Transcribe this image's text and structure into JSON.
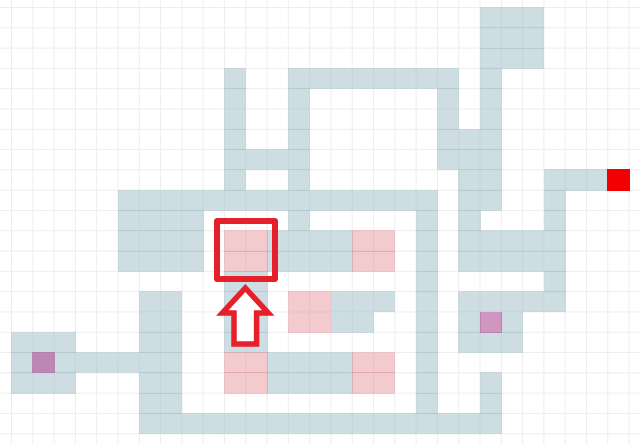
{
  "map": {
    "title_hidden": "",
    "grid": {
      "origin_x": 11,
      "origin_y": 7,
      "cell_w": 21.3,
      "cell_h": 20.3,
      "cols": 30,
      "rows": 22,
      "width": 640,
      "height": 444,
      "line_color": "#ededee",
      "background": "#ffffff"
    },
    "colors": {
      "wall_fill": "rgba(164,193,203,0.55)",
      "pink_fill": "rgba(226,130,140,0.42)",
      "purple_fill": "rgba(178,72,146,0.58)",
      "goal_fill": "#f20000",
      "highlight_red": "#e5202a",
      "arrow_fill": "#ffffff"
    },
    "wall_runs": [
      [
        1,
        23,
        25
      ],
      [
        2,
        23,
        25
      ],
      [
        3,
        23,
        25
      ],
      [
        4,
        11,
        11
      ],
      [
        4,
        14,
        21
      ],
      [
        4,
        23,
        23
      ],
      [
        5,
        11,
        11
      ],
      [
        5,
        14,
        14
      ],
      [
        5,
        21,
        21
      ],
      [
        5,
        23,
        23
      ],
      [
        6,
        11,
        11
      ],
      [
        6,
        14,
        14
      ],
      [
        6,
        21,
        21
      ],
      [
        6,
        23,
        23
      ],
      [
        7,
        11,
        11
      ],
      [
        7,
        14,
        14
      ],
      [
        7,
        21,
        23
      ],
      [
        8,
        11,
        14
      ],
      [
        8,
        21,
        23
      ],
      [
        9,
        11,
        11
      ],
      [
        9,
        14,
        14
      ],
      [
        9,
        22,
        23
      ],
      [
        9,
        26,
        28
      ],
      [
        10,
        6,
        20
      ],
      [
        10,
        22,
        23
      ],
      [
        10,
        26,
        26
      ],
      [
        11,
        6,
        9
      ],
      [
        11,
        14,
        14
      ],
      [
        11,
        20,
        20
      ],
      [
        11,
        22,
        22
      ],
      [
        11,
        26,
        26
      ],
      [
        12,
        6,
        9
      ],
      [
        12,
        13,
        16
      ],
      [
        12,
        20,
        20
      ],
      [
        12,
        22,
        26
      ],
      [
        13,
        6,
        9
      ],
      [
        13,
        13,
        16
      ],
      [
        13,
        20,
        20
      ],
      [
        13,
        22,
        26
      ],
      [
        14,
        11,
        12
      ],
      [
        14,
        20,
        20
      ],
      [
        14,
        26,
        26
      ],
      [
        15,
        7,
        8
      ],
      [
        15,
        11,
        12
      ],
      [
        15,
        16,
        18
      ],
      [
        15,
        20,
        20
      ],
      [
        15,
        22,
        26
      ],
      [
        16,
        7,
        8
      ],
      [
        16,
        11,
        12
      ],
      [
        16,
        16,
        17
      ],
      [
        16,
        20,
        20
      ],
      [
        16,
        22,
        22
      ],
      [
        16,
        24,
        24
      ],
      [
        17,
        1,
        3
      ],
      [
        17,
        7,
        8
      ],
      [
        17,
        11,
        12
      ],
      [
        17,
        20,
        20
      ],
      [
        17,
        22,
        24
      ],
      [
        18,
        1,
        8
      ],
      [
        18,
        13,
        16
      ],
      [
        18,
        20,
        20
      ],
      [
        19,
        1,
        3
      ],
      [
        19,
        7,
        8
      ],
      [
        19,
        13,
        16
      ],
      [
        19,
        20,
        20
      ],
      [
        19,
        23,
        23
      ],
      [
        20,
        7,
        8
      ],
      [
        20,
        20,
        20
      ],
      [
        20,
        23,
        23
      ],
      [
        21,
        7,
        23
      ]
    ],
    "pink_runs": [
      [
        12,
        11,
        12
      ],
      [
        12,
        17,
        18
      ],
      [
        13,
        11,
        12
      ],
      [
        13,
        17,
        18
      ],
      [
        15,
        14,
        15
      ],
      [
        16,
        14,
        15
      ],
      [
        18,
        11,
        12
      ],
      [
        18,
        17,
        18
      ],
      [
        19,
        11,
        12
      ],
      [
        19,
        17,
        18
      ]
    ],
    "purple_cells": [
      {
        "row": 18,
        "col": 2
      },
      {
        "row": 16,
        "col": 23
      }
    ],
    "goal_cell": {
      "row": 9,
      "col": 29
    },
    "highlight_box": {
      "x": 213.5,
      "y": 217.5,
      "w": 64,
      "h": 64,
      "border": 6,
      "radius": 3
    },
    "arrow": {
      "cx": 245.3,
      "apex_y": 288,
      "head_y": 313,
      "head_half_w": 23,
      "shaft_half_w": 11.3,
      "base_y": 344,
      "stroke_w": 5.5
    }
  }
}
